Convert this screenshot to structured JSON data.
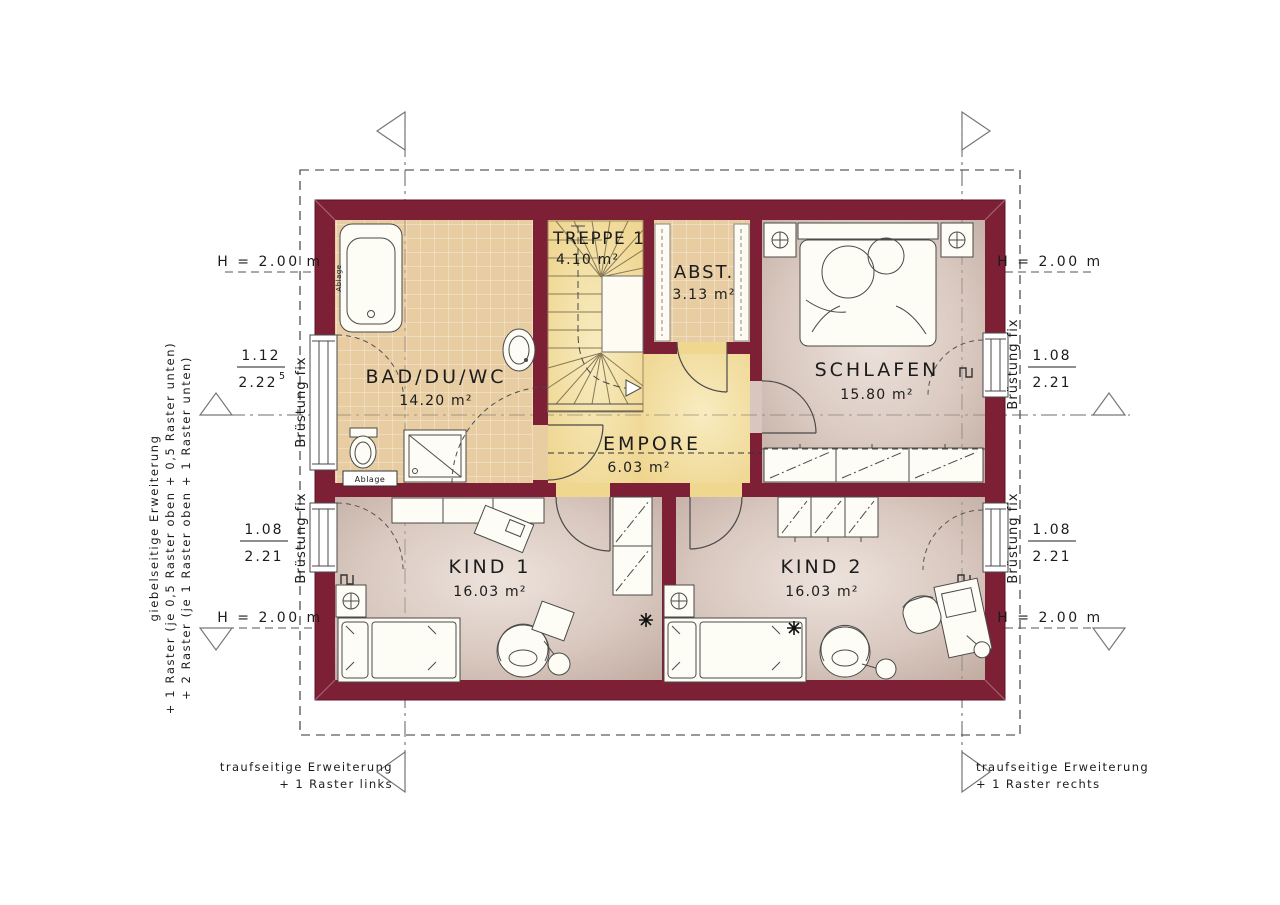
{
  "title": "Dachgeschoss Grundriss",
  "rooms": {
    "bad": {
      "label": "BAD/DU/WC",
      "area": "14.20 m²"
    },
    "treppe": {
      "label": "TREPPE 1",
      "area": "4.10 m²"
    },
    "abst": {
      "label": "ABST.",
      "area": "3.13 m²"
    },
    "schlafen": {
      "label": "SCHLAFEN",
      "area": "15.80 m²"
    },
    "empore": {
      "label": "EMPORE",
      "area": "6.03 m²"
    },
    "kind1": {
      "label": "KIND 1",
      "area": "16.03 m²"
    },
    "kind2": {
      "label": "KIND 2",
      "area": "16.03 m²"
    }
  },
  "dims": {
    "height": "H = 2.00 m",
    "parapet": "Brüstung fix",
    "fraction_left_top": {
      "num": "1.12",
      "den": "2.22",
      "sup": "5"
    },
    "fraction_left_bottom": {
      "num": "1.08",
      "den": "2.21"
    },
    "fraction_right_top": {
      "num": "1.08",
      "den": "2.21"
    },
    "fraction_right_bottom": {
      "num": "1.08",
      "den": "2.21"
    }
  },
  "labels": {
    "ablage": "Ablage"
  },
  "annotations": {
    "gable_title": "giebelseitige Erweiterung",
    "gable_line1": "+ 1 Raster (je 0,5 Raster oben + 0,5 Raster unten)",
    "gable_line2": "+ 2 Raster (je 1 Raster oben + 1 Raster unten)",
    "eave_left_line1": "traufseitige Erweiterung",
    "eave_left_line2": "+ 1 Raster links",
    "eave_right_line1": "traufseitige Erweiterung",
    "eave_right_line2": "+ 1 Raster rechts"
  },
  "colors": {
    "wall": "#7D2035",
    "tile_floor": "#E8CDA3",
    "hall_floor": "#F2DC9C",
    "room_floor": "#CDB9AF",
    "furniture": "#FBF7EA",
    "line": "#4A4A4A"
  }
}
